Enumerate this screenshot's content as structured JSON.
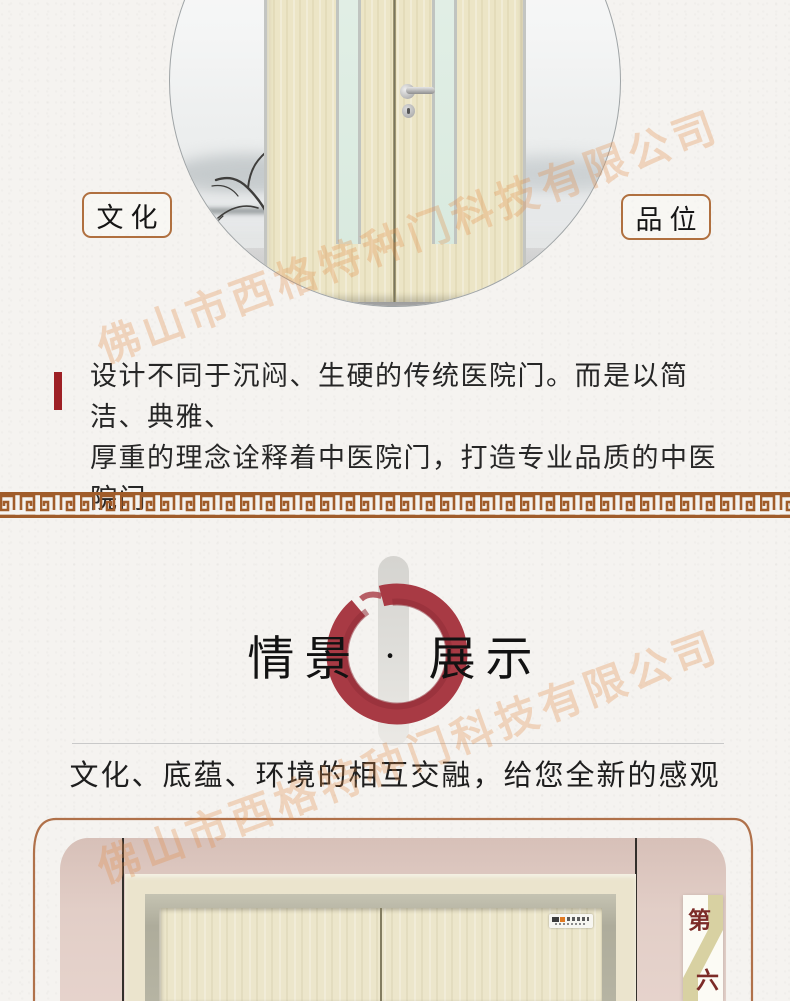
{
  "company_watermark": {
    "text": "佛山市西格特种门科技有限公司"
  },
  "hero": {
    "left_label": "文化",
    "right_label": "品位"
  },
  "intro": {
    "line1": "设计不同于沉闷、生硬的传统医院门。而是以简洁、典雅、",
    "line2": "厚重的理念诠释着中医院门，打造专业品质的中医院门"
  },
  "showcase": {
    "title_left": "情景",
    "title_dot": "·",
    "title_right": "展示",
    "tagline": "文化、底蕴、环境的相互交融，给您全新的感观"
  },
  "badge": {
    "top": "第",
    "bottom": "六"
  },
  "colors": {
    "accent_red": "#9e2025",
    "enso_red": "#a83a44",
    "meander_brown": "#a05c2a",
    "label_border": "#b0703f",
    "frame_line": "#b0714a",
    "badge_text": "#7c2b28",
    "watermark": "rgba(224,140,70,0.30)"
  }
}
